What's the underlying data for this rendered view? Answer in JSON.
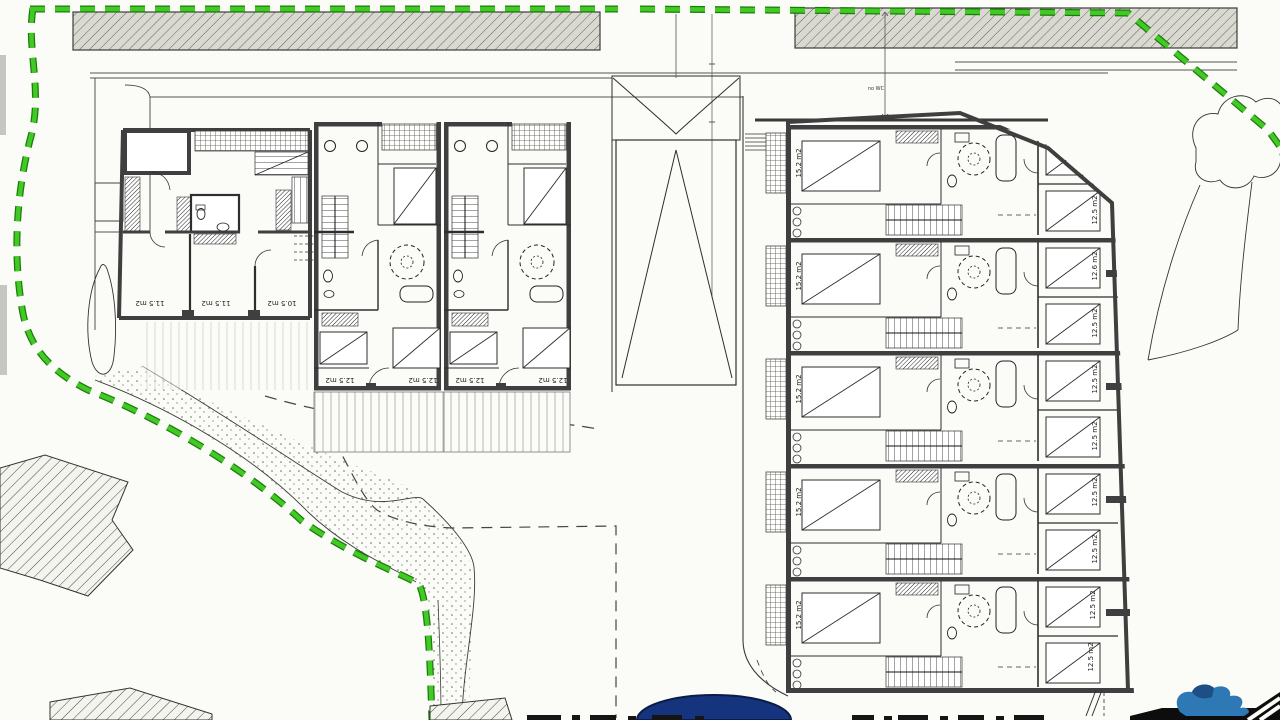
{
  "plan": {
    "left_building": {
      "house_a_rooms": [
        "11.5 m2",
        "11.5 m2",
        "10.5 m2"
      ],
      "house_b_rooms": [
        "12.5 m2",
        "12.5 m2"
      ],
      "house_c_rooms": [
        "12.5 m2",
        "12.5 m2"
      ]
    },
    "right_building": {
      "large_rooms": [
        "15.2 m2",
        "15.2 m2",
        "15.2 m2",
        "15.2 m2",
        "15.2 m2"
      ],
      "small_rooms": [
        "12.5 m2",
        "12.6 m2",
        "12.5 m2",
        "12.5 m2",
        "12.5 m2",
        "12.5 m2",
        "12.5 m2",
        "12.5 m2",
        "12.5 m2"
      ]
    },
    "annotations": {
      "wc_note": "no WC"
    },
    "colors": {
      "boundary_green": "#41c924",
      "pool_blue": "#16337d",
      "logo_blue": "#2e78b5",
      "road_fill": "#d9d9d2",
      "wall_gray": "#3f3f3f"
    }
  }
}
